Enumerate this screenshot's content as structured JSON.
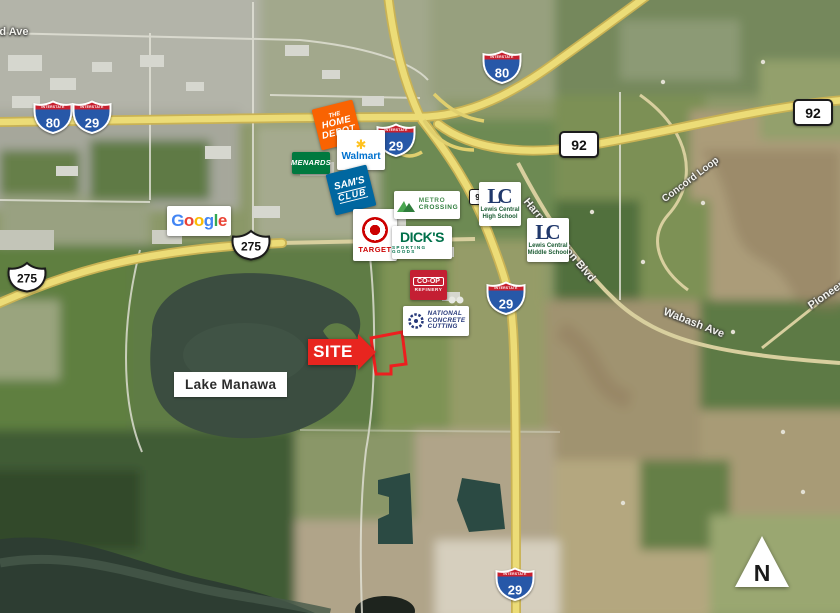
{
  "shields": {
    "banner": "INTERSTATE",
    "i80": "80",
    "i29": "29",
    "ia92": "92",
    "us275": "275"
  },
  "labels": {
    "site": "SITE",
    "lake": "Lake Manawa",
    "north": "N",
    "streets": [
      {
        "text": "3rd Ave"
      },
      {
        "text": "Wabash Ave"
      },
      {
        "text": "Harry Langdon Blvd"
      },
      {
        "text": "Pioneer Trail"
      },
      {
        "text": "Concord Loop"
      }
    ]
  },
  "logos": {
    "home_depot": {
      "line1": "THE",
      "line2": "HOME",
      "line3": "DEPOT"
    },
    "walmart": {
      "name": "Walmart",
      "spark_icon": "✱"
    },
    "menards": {
      "name": "MENARDS"
    },
    "sams_club": {
      "line1": "SAM'S",
      "line2": "CLUB"
    },
    "google": {
      "letters": [
        "G",
        "o",
        "o",
        "g",
        "l",
        "e"
      ]
    },
    "target": {
      "name": "TARGET"
    },
    "metro_crossing": {
      "line1": "METRO",
      "line2": "CROSSING"
    },
    "dicks": {
      "name": "DICK'S",
      "subtitle": "SPORTING GOODS"
    },
    "coop_refinery": {
      "name": "CO-OP",
      "subtitle": "REFINERY"
    },
    "national_concrete": {
      "line1": "NATIONAL",
      "line2": "CONCRETE",
      "line3": "CUTTING"
    },
    "lewis_central_high": {
      "monogram": "LC",
      "line1": "Lewis Central",
      "line2": "High School"
    },
    "lewis_central_middle": {
      "monogram": "LC",
      "line1": "Lewis Central",
      "line2": "Middle School"
    }
  },
  "colors": {
    "site_red": "#e8251f",
    "interstate_blue": "#2758a8",
    "interstate_red": "#c8202f",
    "highway_yellow": "#ecdc77",
    "home_depot_orange": "#f96302",
    "menards_green": "#00793f",
    "sams_blue": "#0067a0",
    "walmart_blue": "#0071ce",
    "walmart_yellow": "#ffc220",
    "target_red": "#cc0000",
    "dicks_green": "#00704a",
    "metro_green": "#2e7d3c",
    "coop_red": "#c41f33",
    "ncc_navy": "#26387a",
    "lc_navy": "#20386b",
    "school_green": "#1c5c34"
  }
}
